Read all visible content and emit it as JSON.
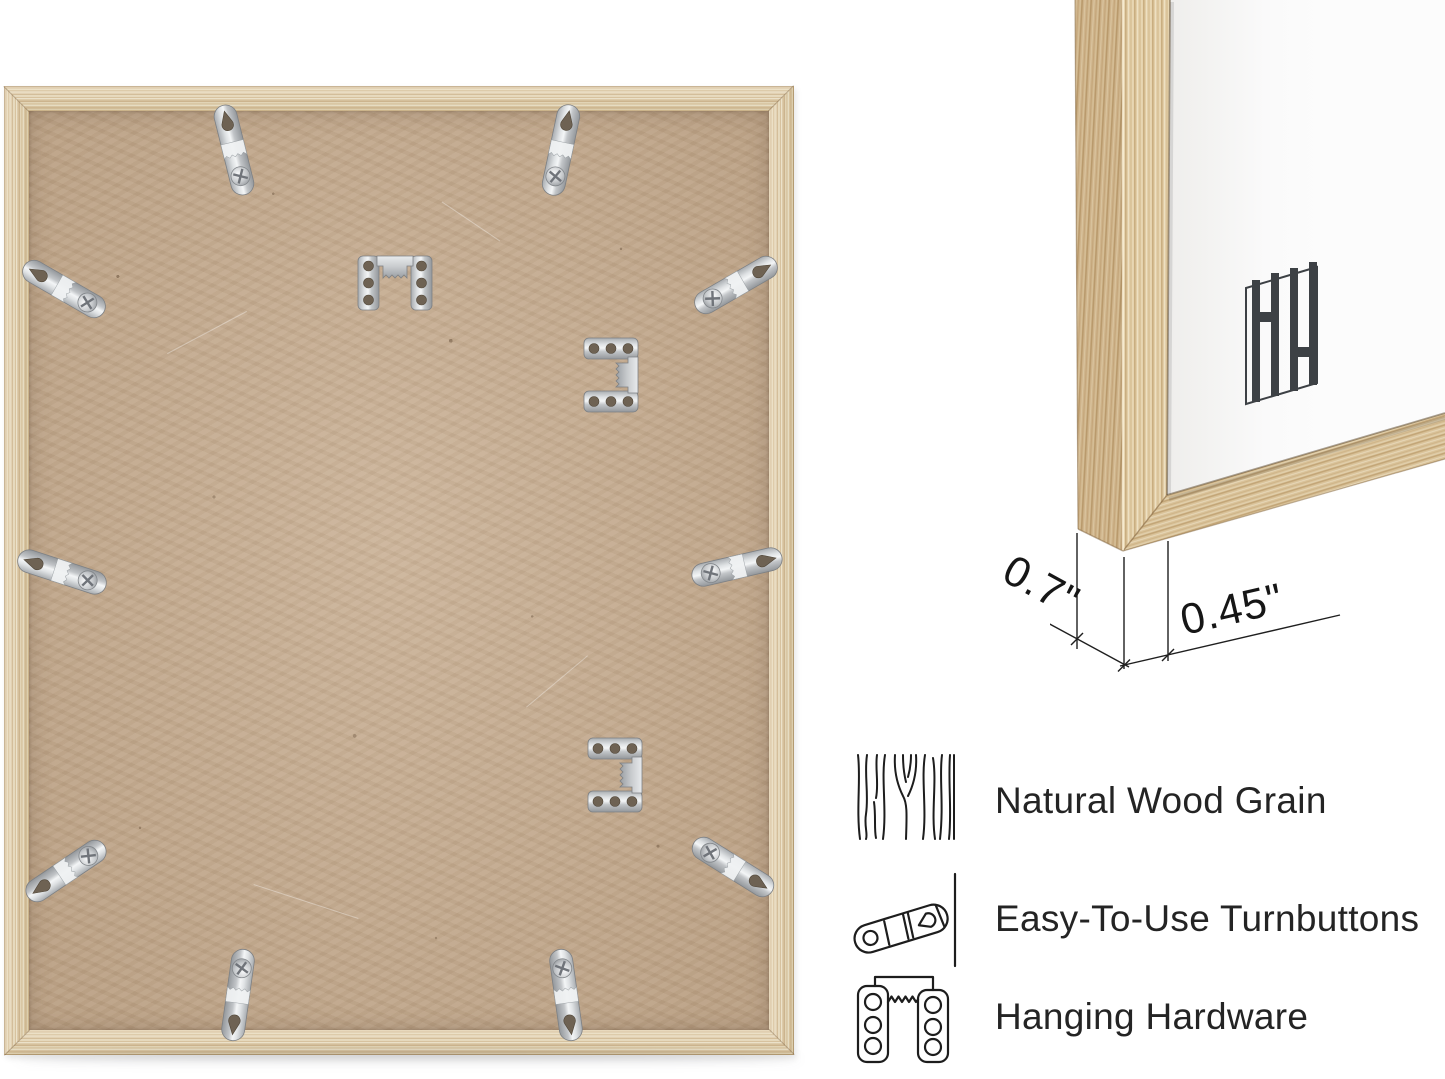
{
  "image_type": "product-infographic",
  "brand": {
    "monogram": "HH"
  },
  "dimensions": {
    "depth_label": "0.7\"",
    "face_label": "0.45\""
  },
  "features": {
    "items": [
      {
        "icon": "wood-grain-icon",
        "label": "Natural Wood Grain"
      },
      {
        "icon": "turnbutton-icon",
        "label": "Easy-To-Use Turnbuttons"
      },
      {
        "icon": "hanging-hardware-icon",
        "label": "Hanging Hardware"
      }
    ]
  },
  "hardware": {
    "turnbutton_count": 10,
    "sawtooth_hanger_count": 3
  },
  "colors": {
    "page_background": "#ffffff",
    "wood_base": "#dcc69e",
    "wood_streak": "#cdb184",
    "wood_highlight": "#efe3c6",
    "backing_board": "#c6ab8d",
    "metal_light": "#f4f6f7",
    "metal_mid": "#c2c5c8",
    "metal_dark": "#93979b",
    "logo": "#3d4145",
    "annotation_line": "#1f1f1f",
    "text": "#242424"
  }
}
